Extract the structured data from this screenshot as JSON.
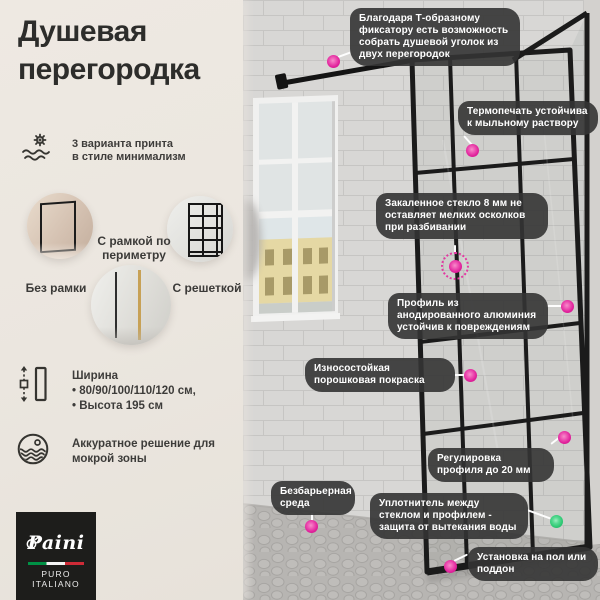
{
  "panel": {
    "title": "Душевая перегородка",
    "print_feature": "3 варианта принта\nв стиле минимализм",
    "variants": [
      {
        "label": "С рамкой по периметру"
      },
      {
        "label": "Без рамки"
      },
      {
        "label": "С решеткой"
      }
    ],
    "dimensions": "Ширина\n• 80/90/100/110/120 см,\n• Высота 195 см",
    "wet_zone": "Аккуратное решение для\nмокрой зоны",
    "logo": {
      "brand": "Paini",
      "tagline": "PURO ITALIANO",
      "flag_colors": [
        "#009246",
        "#f4f4f4",
        "#ce2b37"
      ]
    }
  },
  "scene": {
    "callouts": [
      {
        "text": "Благодаря Т-образному фиксатору есть возможность собрать душевой уголок из двух перегородок",
        "dot_color": "#e0219b"
      },
      {
        "text": "Термопечать устойчива к мыльному раствору",
        "dot_color": "#e0219b"
      },
      {
        "text": "Закаленное стекло 8 мм не оставляет мелких осколков при разбивании",
        "dot_color": "#e0219b"
      },
      {
        "text": "Профиль из анодированного алюминия устойчив к повреждениям",
        "dot_color": "#e0219b"
      },
      {
        "text": "Износостойкая порошковая покраска",
        "dot_color": "#e0219b"
      },
      {
        "text": "Регулировка профиля до 20 мм",
        "dot_color": "#e0219b"
      },
      {
        "text": "Безбарьерная среда",
        "dot_color": "#e0219b"
      },
      {
        "text": "Уплотнитель между стеклом и профилем - защита от вытекания воды",
        "dot_color": "#2ec873"
      },
      {
        "text": "Установка на пол или поддон",
        "dot_color": "#e0219b"
      }
    ],
    "dot_colors": {
      "pink": "#e0219b",
      "green": "#2ec873"
    }
  }
}
